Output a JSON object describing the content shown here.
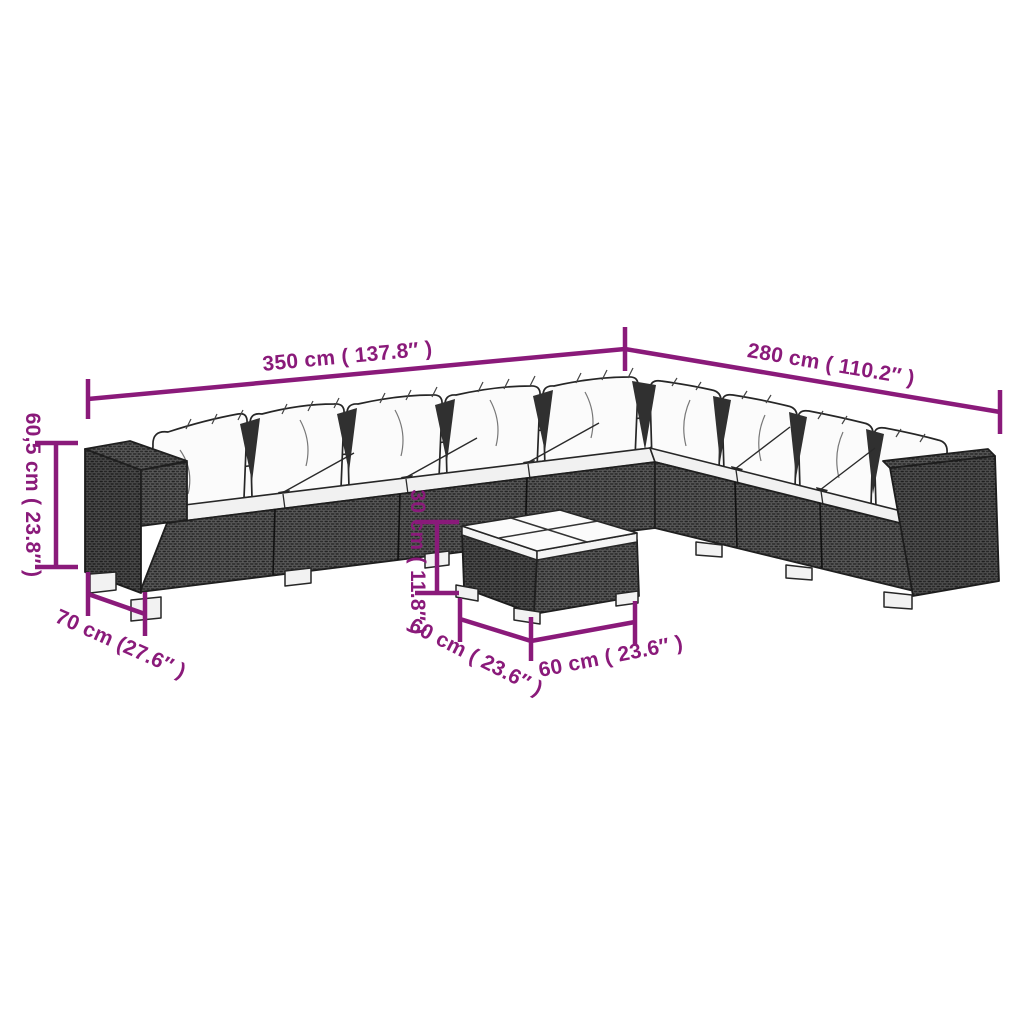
{
  "page": {
    "background": "#ffffff"
  },
  "diagram": {
    "type": "product-dimension-diagram",
    "subject": "L-shaped rattan garden lounge set with coffee table",
    "accent_color": "#8a1a7a",
    "outline_color": "#262626",
    "rattan_color": "#595959",
    "cushion_color": "#fbfbfb",
    "dimensions": {
      "dim_350": {
        "label": "350 cm ( 137.8″ )",
        "cm": 350,
        "inches": 137.8,
        "measures": "sofa long side width"
      },
      "dim_280": {
        "label": "280 cm ( 110.2″ )",
        "cm": 280,
        "inches": 110.2,
        "measures": "sofa short side width"
      },
      "dim_60_5": {
        "label": "60,5 cm ( 23.8″ )",
        "cm": 60.5,
        "inches": 23.8,
        "measures": "sofa height"
      },
      "dim_70": {
        "label": "70 cm (27.6″ )",
        "cm": 70,
        "inches": 27.6,
        "measures": "sofa depth"
      },
      "dim_30": {
        "label": "30 cm ( 11.8″ )",
        "cm": 30,
        "inches": 11.8,
        "measures": "table height"
      },
      "dim_60_front": {
        "label": "60 cm ( 23.6″ )",
        "cm": 60,
        "inches": 23.6,
        "measures": "table width"
      },
      "dim_60_side": {
        "label": "60 cm ( 23.6″ )",
        "cm": 60,
        "inches": 23.6,
        "measures": "table depth"
      }
    }
  }
}
